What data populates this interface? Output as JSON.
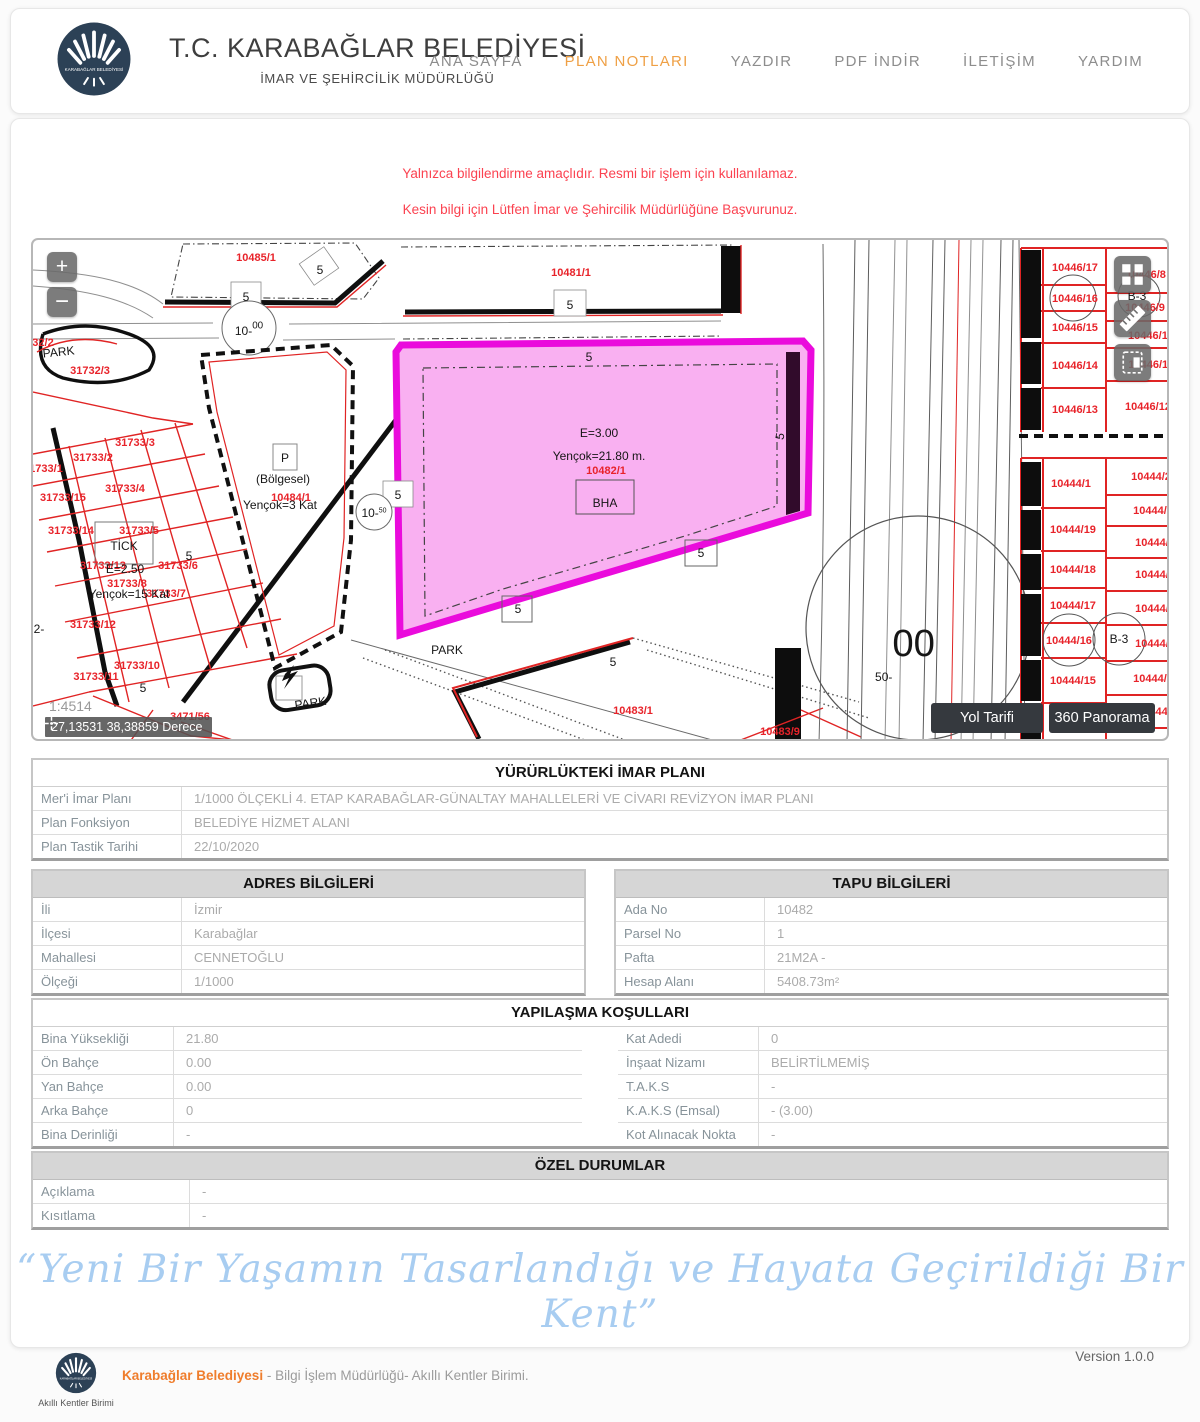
{
  "header": {
    "title": "T.C. KARABAĞLAR BELEDİYESİ",
    "subtitle": "İMAR VE ŞEHİRCİLİK MÜDÜRLÜĞÜ",
    "nav": [
      {
        "label": "ANA SAYFA",
        "active": false
      },
      {
        "label": "PLAN NOTLARI",
        "active": true
      },
      {
        "label": "YAZDIR",
        "active": false
      },
      {
        "label": "PDF İNDİR",
        "active": false
      },
      {
        "label": "İLETİŞİM",
        "active": false
      },
      {
        "label": "YARDIM",
        "active": false
      }
    ],
    "accent_color": "#efa045"
  },
  "warnings": {
    "line1": "Yalnızca bilgilendirme amaçlıdır. Resmi bir işlem için kullanılamaz.",
    "line2": "Kesin bilgi için Lütfen İmar ve Şehircilik Müdürlüğüne Başvurunuz.",
    "color": "#fb4250"
  },
  "map": {
    "zoom_in": "+",
    "zoom_out": "−",
    "scale_text": "1:4514",
    "coordinates": "27,13531 38,38859 Derece",
    "directions_button": "Yol Tarifi",
    "panorama_button": "360 Panorama",
    "highlight_color": "#ea0bdc",
    "highlight_fill": "#f9b0f1",
    "parcel_red": "#e8232a",
    "labels": [
      {
        "t": "10485/1",
        "x": 223,
        "y": 21,
        "c": "red"
      },
      {
        "t": "10481/1",
        "x": 538,
        "y": 36,
        "c": "red"
      },
      {
        "t": "32/2",
        "x": 10,
        "y": 106,
        "c": "red"
      },
      {
        "t": "31732/3",
        "x": 57,
        "y": 134,
        "c": "red"
      },
      {
        "t": "31733/3",
        "x": 102,
        "y": 206,
        "c": "red"
      },
      {
        "t": "31733/2",
        "x": 60,
        "y": 221,
        "c": "red"
      },
      {
        "t": "1733/1",
        "x": 13,
        "y": 232,
        "c": "red"
      },
      {
        "t": "31733/4",
        "x": 92,
        "y": 252,
        "c": "red"
      },
      {
        "t": "31733/15",
        "x": 30,
        "y": 261,
        "c": "red"
      },
      {
        "t": "31733/14",
        "x": 38,
        "y": 294,
        "c": "red"
      },
      {
        "t": "31733/5",
        "x": 106,
        "y": 294,
        "c": "red"
      },
      {
        "t": "31733/13",
        "x": 70,
        "y": 329,
        "c": "red"
      },
      {
        "t": "31733/6",
        "x": 145,
        "y": 329,
        "c": "red"
      },
      {
        "t": "31733/8",
        "x": 94,
        "y": 347,
        "c": "red"
      },
      {
        "t": "31733/7",
        "x": 133,
        "y": 357,
        "c": "red"
      },
      {
        "t": "31733/12",
        "x": 60,
        "y": 388,
        "c": "red"
      },
      {
        "t": "31733/10",
        "x": 104,
        "y": 429,
        "c": "red"
      },
      {
        "t": "31733/11",
        "x": 63,
        "y": 440,
        "c": "red"
      },
      {
        "t": "3471/56",
        "x": 157,
        "y": 480,
        "c": "red"
      },
      {
        "t": "10484/1",
        "x": 258,
        "y": 261,
        "c": "red"
      },
      {
        "t": "10482/1",
        "x": 573,
        "y": 234,
        "c": "red"
      },
      {
        "t": "10483/1",
        "x": 600,
        "y": 474,
        "c": "red"
      },
      {
        "t": "10483/9",
        "x": 747,
        "y": 495,
        "c": "red"
      },
      {
        "t": "10446/17",
        "x": 1042,
        "y": 31,
        "c": "red"
      },
      {
        "t": "10446/16",
        "x": 1042,
        "y": 62,
        "c": "red"
      },
      {
        "t": "10446/15",
        "x": 1042,
        "y": 91,
        "c": "red"
      },
      {
        "t": "10446/14",
        "x": 1042,
        "y": 129,
        "c": "red"
      },
      {
        "t": "10446/13",
        "x": 1042,
        "y": 173,
        "c": "red"
      },
      {
        "t": "10446/8",
        "x": 1113,
        "y": 38,
        "c": "red"
      },
      {
        "t": "10446/9",
        "x": 1112,
        "y": 71,
        "c": "red"
      },
      {
        "t": "10446/10",
        "x": 1118,
        "y": 99,
        "c": "red"
      },
      {
        "t": "10446/11",
        "x": 1118,
        "y": 128,
        "c": "red"
      },
      {
        "t": "10446/12",
        "x": 1115,
        "y": 170,
        "c": "red"
      },
      {
        "t": "10444/1",
        "x": 1038,
        "y": 247,
        "c": "red"
      },
      {
        "t": "10444/19",
        "x": 1040,
        "y": 293,
        "c": "red"
      },
      {
        "t": "10444/18",
        "x": 1040,
        "y": 333,
        "c": "red"
      },
      {
        "t": "10444/17",
        "x": 1040,
        "y": 369,
        "c": "red"
      },
      {
        "t": "10444/16",
        "x": 1036,
        "y": 404,
        "c": "red"
      },
      {
        "t": "10444/15",
        "x": 1040,
        "y": 444,
        "c": "red"
      },
      {
        "t": "10444/2",
        "x": 1118,
        "y": 240,
        "c": "red"
      },
      {
        "t": "10444/3",
        "x": 1120,
        "y": 274,
        "c": "red"
      },
      {
        "t": "10444/4",
        "x": 1122,
        "y": 306,
        "c": "red"
      },
      {
        "t": "10444/5",
        "x": 1122,
        "y": 338,
        "c": "red"
      },
      {
        "t": "10444/6",
        "x": 1122,
        "y": 372,
        "c": "red"
      },
      {
        "t": "10444/7",
        "x": 1122,
        "y": 407,
        "c": "red"
      },
      {
        "t": "10444/8",
        "x": 1120,
        "y": 442,
        "c": "red"
      },
      {
        "t": "10444/9",
        "x": 1124,
        "y": 475,
        "c": "red"
      },
      {
        "t": "5",
        "x": 287,
        "y": 34,
        "fs": 20
      },
      {
        "t": "5",
        "x": 213,
        "y": 61,
        "fs": 20
      },
      {
        "t": "5",
        "x": 537,
        "y": 69,
        "fs": 20
      },
      {
        "t": "5",
        "x": 556,
        "y": 121,
        "fs": 20
      },
      {
        "t": "5",
        "x": 365,
        "y": 259,
        "fs": 20
      },
      {
        "t": "5",
        "x": 751,
        "y": 197,
        "fs": 20,
        "r": -80
      },
      {
        "t": "5",
        "x": 668,
        "y": 317,
        "fs": 20
      },
      {
        "t": "5",
        "x": 485,
        "y": 373,
        "fs": 20
      },
      {
        "t": "5",
        "x": 580,
        "y": 426,
        "fs": 20
      },
      {
        "t": "5",
        "x": 156,
        "y": 320,
        "fs": 20
      },
      {
        "t": "5",
        "x": 110,
        "y": 452,
        "fs": 22
      },
      {
        "t": "2-",
        "x": 6,
        "y": 393,
        "fs": 15
      },
      {
        "t": "PARK",
        "x": 26,
        "y": 116,
        "fs": 16,
        "r": -6
      },
      {
        "t": "PARK",
        "x": 414,
        "y": 414,
        "fs": 15
      },
      {
        "t": "PARK",
        "x": 278,
        "y": 467,
        "fs": 14,
        "r": -8
      },
      {
        "t": "P",
        "x": 252,
        "y": 222,
        "fs": 17
      },
      {
        "t": "(Bölgesel)",
        "x": 250,
        "y": 243,
        "fs": 16
      },
      {
        "t": "Yençok=3 Kat",
        "x": 247,
        "y": 269,
        "fs": 16
      },
      {
        "t": "TİCK",
        "x": 91,
        "y": 310,
        "fs": 17
      },
      {
        "t": "E=2.50",
        "x": 92,
        "y": 333,
        "fs": 17
      },
      {
        "t": "Yençok=15 Kat",
        "x": 96,
        "y": 358,
        "fs": 15
      },
      {
        "t": "E=3.00",
        "x": 566,
        "y": 197,
        "fs": 19
      },
      {
        "t": "Yençok=21.80 m.",
        "x": 566,
        "y": 220,
        "fs": 19
      },
      {
        "t": "BHA",
        "x": 572,
        "y": 267,
        "fs": 19
      },
      {
        "t": "B-3",
        "x": 1104,
        "y": 60,
        "fs": 11
      },
      {
        "t": "B-3",
        "x": 1086,
        "y": 403,
        "fs": 12
      },
      {
        "t": "50-",
        "sup": "00",
        "x": 872,
        "y": 441,
        "fs": 66
      },
      {
        "t": "10-",
        "sup": "00",
        "x": 216,
        "y": 95,
        "fs": 17
      },
      {
        "t": "10-",
        "sup": "50",
        "x": 341,
        "y": 277,
        "fs": 12
      }
    ]
  },
  "tables": {
    "plan": {
      "title": "YÜRÜRLÜKTEKİ İMAR PLANI",
      "rows": [
        {
          "label": "Mer'i İmar Planı",
          "value": "1/1000 ÖLÇEKLİ 4. ETAP KARABAĞLAR-GÜNALTAY MAHALLELERİ VE CİVARI REVİZYON İMAR PLANI"
        },
        {
          "label": "Plan Fonksiyon",
          "value": "BELEDİYE HİZMET ALANI"
        },
        {
          "label": "Plan Tastik Tarihi",
          "value": "22/10/2020"
        }
      ]
    },
    "adres": {
      "title": "ADRES BİLGİLERİ",
      "rows": [
        {
          "label": "İli",
          "value": "İzmir"
        },
        {
          "label": "İlçesi",
          "value": "Karabağlar"
        },
        {
          "label": "Mahallesi",
          "value": "CENNETOĞLU"
        },
        {
          "label": "Ölçeği",
          "value": "1/1000"
        }
      ]
    },
    "tapu": {
      "title": "TAPU BİLGİLERİ",
      "rows": [
        {
          "label": "Ada No",
          "value": "10482"
        },
        {
          "label": "Parsel No",
          "value": "1"
        },
        {
          "label": "Pafta",
          "value": "21M2A -"
        },
        {
          "label": "Hesap Alanı",
          "value": "5408.73m²"
        }
      ]
    },
    "yapilasma": {
      "title": "YAPILAŞMA KOŞULLARI",
      "left": [
        {
          "label": "Bina Yüksekliği",
          "value": "21.80"
        },
        {
          "label": "Ön Bahçe",
          "value": "0.00"
        },
        {
          "label": "Yan Bahçe",
          "value": "0.00"
        },
        {
          "label": "Arka Bahçe",
          "value": "0"
        },
        {
          "label": "Bina Derinliği",
          "value": "-"
        }
      ],
      "right": [
        {
          "label": "Kat Adedi",
          "value": "0"
        },
        {
          "label": "İnşaat Nizamı",
          "value": "BELİRTİLMEMİŞ"
        },
        {
          "label": "T.A.K.S",
          "value": "-"
        },
        {
          "label": "K.A.K.S (Emsal)",
          "value": "- (3.00)"
        },
        {
          "label": "Kot Alınacak Nokta",
          "value": "-"
        }
      ]
    },
    "ozel": {
      "title": "ÖZEL DURUMLAR",
      "rows": [
        {
          "label": "Açıklama",
          "value": "-"
        },
        {
          "label": "Kısıtlama",
          "value": "-"
        }
      ]
    }
  },
  "slogan": "“Yeni Bir Yaşamın Tasarlandığı ve Hayata Geçirildiği Bir Kent”",
  "footer": {
    "org": "Karabağlar Belediyesi",
    "rest": " - Bilgi İşlem Müdürlüğü- Akıllı Kentler Birimi.",
    "unit_caption": "Akıllı Kentler Birimi",
    "version": "Version 1.0.0"
  }
}
